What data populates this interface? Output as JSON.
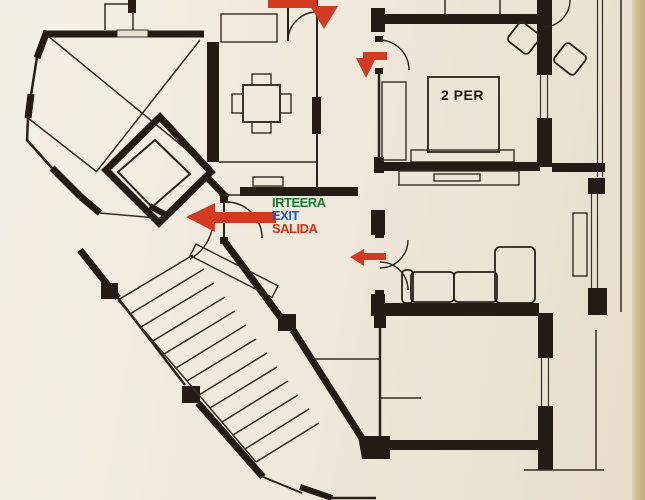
{
  "title": "Evacuation floor plan photo",
  "exit_sign": {
    "irteera": "IRTEERA",
    "exit": "EXIT",
    "salida": "SALIDA"
  },
  "labels": {
    "bedroom_capacity": "2 PER"
  },
  "colors": {
    "paper": "#efe9dc",
    "paper_edge": "#d2bd92",
    "wall": "#241c14",
    "arrow_red": "#d23a21",
    "sign_green": "#167d36",
    "sign_blue": "#1560c2",
    "sign_red": "#d6301c"
  },
  "icons": {
    "arrows": [
      {
        "name": "corridor-arrow-top",
        "direction": "down"
      },
      {
        "name": "bedroom-door-arrow",
        "direction": "down"
      },
      {
        "name": "main-exit-arrow",
        "direction": "left"
      },
      {
        "name": "hall-door-arrow",
        "direction": "left"
      }
    ]
  }
}
